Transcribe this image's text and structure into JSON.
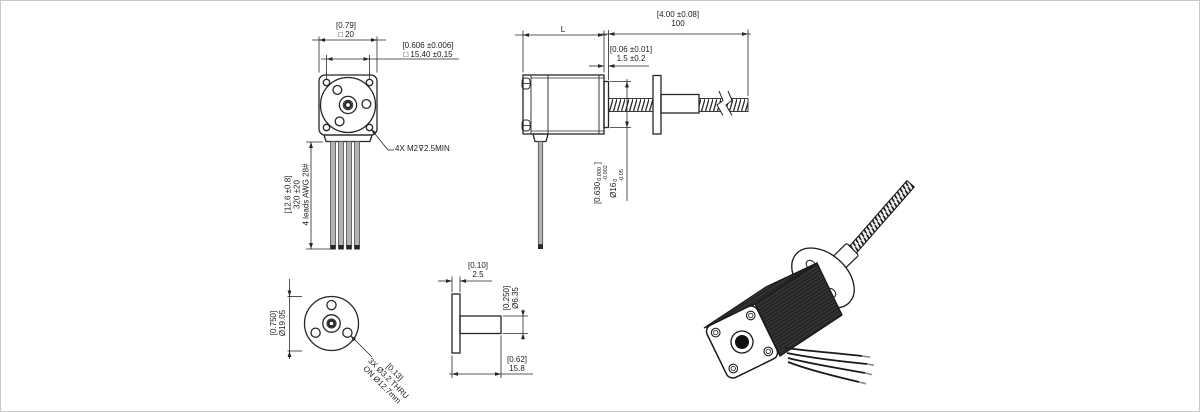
{
  "colors": {
    "line": "#262626",
    "text": "#1c1c1c",
    "canvas_border": "#c9c9c9",
    "background": "#ffffff"
  },
  "drawing": {
    "front_view": {
      "dim_width_in": "[0.79]",
      "dim_width_mm": "□ 20",
      "dim_hole_spacing_in": "[0.606 ±0.006]",
      "dim_hole_spacing_mm": "□ 15.40 ±0.15",
      "mounting_callout": "4X M2⊽2.5MIN",
      "leads_length_in": "[12.6 ±0.8]",
      "leads_length_mm": "320 ±20",
      "leads_note": "4 leads AWG 28#"
    },
    "side_view": {
      "dim_body_length": "L",
      "dim_screw_length_in": "[4.00 ±0.08]",
      "dim_screw_length_mm": "100",
      "dim_pilot_height_in": "[0.06 ±0.01]",
      "dim_pilot_height_mm": "1.5 ±0.2",
      "pilot_dia_in_main": "[0.630",
      "pilot_dia_in_tol_upper": "0.000",
      "pilot_dia_in_tol_lower": "-0.002",
      "pilot_dia_in_close": "]",
      "pilot_dia_mm_main": "Ø16",
      "pilot_dia_mm_tol_upper": "0",
      "pilot_dia_mm_tol_lower": "-0.05"
    },
    "nut_front_view": {
      "dim_flange_dia_in": "[0.750]",
      "dim_flange_dia_mm": "Ø19.05",
      "holes_callout_in": "[0.13]",
      "holes_callout_line1": "3X Ø3.2 THRU",
      "holes_callout_line2": "ON Ø12.7mm"
    },
    "nut_side_view": {
      "dim_flange_thickness_in": "[0.10]",
      "dim_flange_thickness_mm": "2.5",
      "dim_barrel_dia_in": "[0.250]",
      "dim_barrel_dia_mm": "Ø6.35",
      "dim_overall_length_in": "[0.62]",
      "dim_overall_length_mm": "15.8"
    }
  }
}
